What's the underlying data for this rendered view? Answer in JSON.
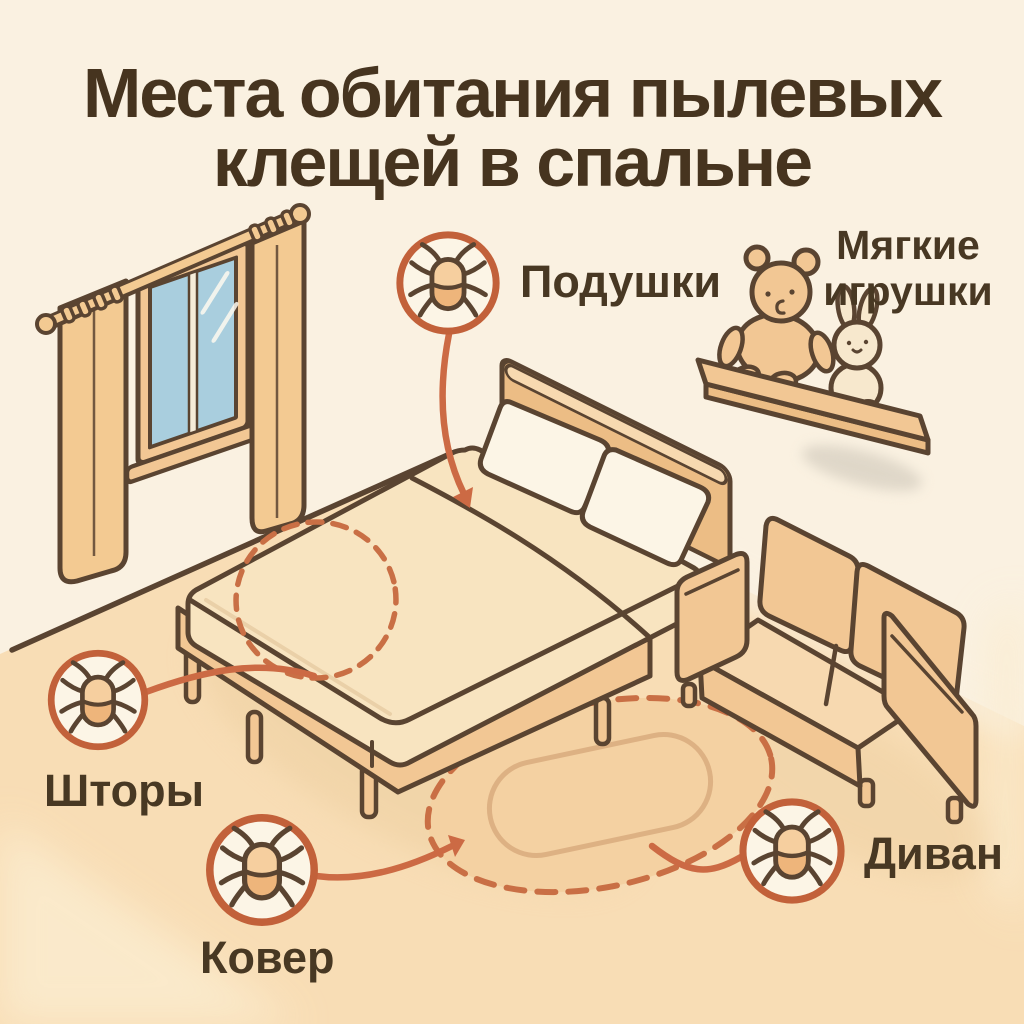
{
  "title": {
    "line1": "Места обитания пылевых",
    "line2": "клещей в спальне"
  },
  "labels": {
    "pillows": "Подушки",
    "soft_toys_line1": "Мягкие",
    "soft_toys_line2": "игрушки",
    "curtains": "Шторы",
    "carpet": "Ковер",
    "sofa": "Диван"
  },
  "icons": {
    "badge": "dust-mite-icon"
  },
  "palette": {
    "bg_wall": "#faf1e1",
    "floor": "#f8ddb5",
    "floor_light": "#fbeccf",
    "outline": "#5a4431",
    "title_text": "#46341f",
    "label_text": "#483823",
    "furniture": "#f2c794",
    "furniture_light": "#f7d9b0",
    "furniture_dark": "#ecbd85",
    "sheet": "#f8e4c0",
    "pillow": "#fcf5e6",
    "glass": "#a9cede",
    "curtain": "#f3ca92",
    "accent": "#c2613a",
    "arrow": "#cc6a44",
    "dashed": "#c96f45",
    "mite_top": "#f6cf9f",
    "mite_bottom": "#eeb57b",
    "badge_fill": "#fcf5e6",
    "rug": "#f4d1a2",
    "rug_inner": "#ddb183",
    "shadow": "#ecce9f",
    "shelf_shadow": "#d9d1c3"
  }
}
